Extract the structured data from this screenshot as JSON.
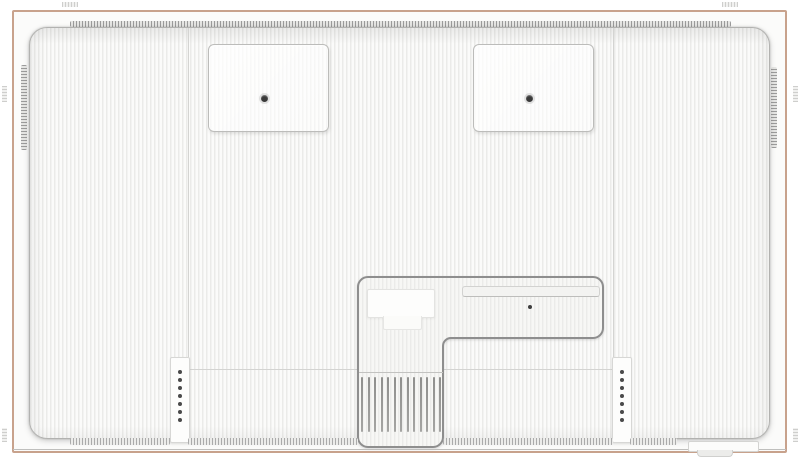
{
  "scene": {
    "type": "technical-illustration",
    "subject": "display-rear-view"
  },
  "colors": {
    "frame-edge": "#c8a28c",
    "panel-border": "#b2b2b0",
    "stripe-dark": "#ebebe9",
    "stripe-light": "#fbfbfa",
    "seam": "#d4d4d2",
    "vent-dash-dark": "#9b9b9b",
    "vent-dash-light": "#ababab",
    "recess-border": "#8e8e8e",
    "recess-fill": "#f7f7f5",
    "screw-dark": "#3a3a3a",
    "hole-dark": "#4a4a4a",
    "baseline": "#bfbfbd"
  },
  "components": {
    "vesa_mounts": {
      "count": 2,
      "screws_per_mount": 1
    },
    "screw_strips": {
      "count": 2,
      "holes_per_strip": 7,
      "hole_spacing_px": 8,
      "first_hole_offset_px": 12
    },
    "vent_slats": {
      "count": 13,
      "spacing_px": 6.5
    },
    "bottom_vent_segments": {
      "count": 4
    },
    "edge_vents": {
      "top": 1,
      "left": 1,
      "right": 1
    },
    "recess": {
      "label_plates": 2,
      "slot_bands": 1,
      "screws": 1
    }
  }
}
